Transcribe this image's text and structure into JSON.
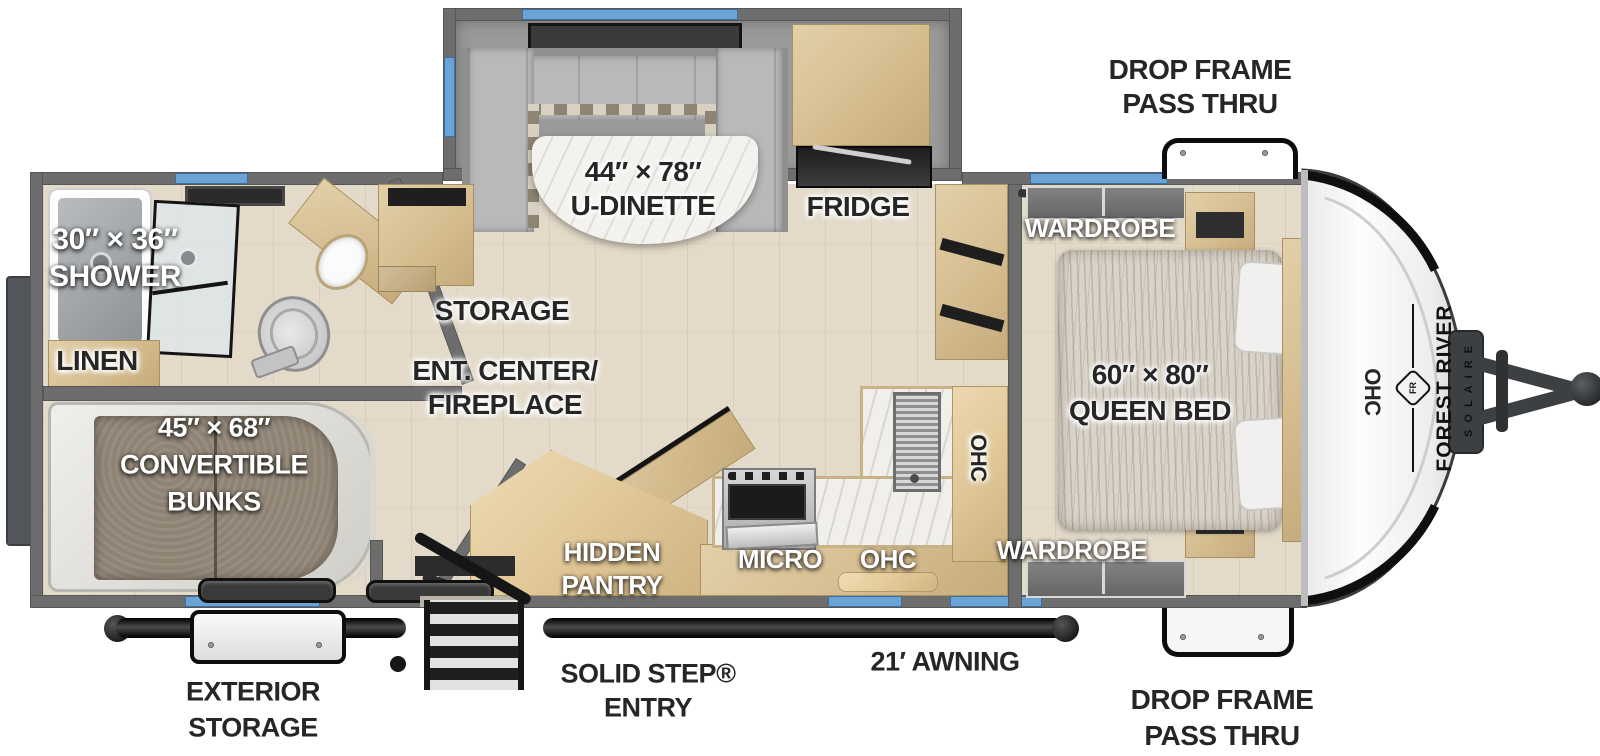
{
  "title": "Forest River Solaire travel trailer floor plan",
  "brand": {
    "name": "FOREST RIVER",
    "model": "SOLAIRE",
    "logo_monogram": "FR"
  },
  "labels": {
    "drop_frame_top_1": "DROP FRAME",
    "drop_frame_top_2": "PASS THRU",
    "dinette_size": "44″ × 78″",
    "dinette_name": "U-DINETTE",
    "fridge": "FRIDGE",
    "wardrobe_top": "WARDROBE",
    "wardrobe_bottom": "WARDROBE",
    "shower_size": "30″ × 36″",
    "shower_name": "SHOWER",
    "linen": "LINEN",
    "storage": "STORAGE",
    "ent_center_1": "ENT. CENTER/",
    "ent_center_2": "FIREPLACE",
    "bunks_size": "45″ × 68″",
    "bunks_name_1": "CONVERTIBLE",
    "bunks_name_2": "BUNKS",
    "hidden_pantry_1": "HIDDEN",
    "hidden_pantry_2": "PANTRY",
    "micro": "MICRO",
    "ohc_kitchen_lower": "OHC",
    "ohc_kitchen_upper": "OHC",
    "ohc_front": "OHC",
    "queen_size": "60″ × 80″",
    "queen_name": "QUEEN BED",
    "exterior_storage_1": "EXTERIOR",
    "exterior_storage_2": "STORAGE",
    "solid_step_1": "SOLID STEP®",
    "solid_step_2": "ENTRY",
    "awning": "21′ AWNING",
    "drop_frame_bottom_1": "DROP FRAME",
    "drop_frame_bottom_2": "PASS THRU"
  },
  "colors": {
    "window_blue": "#6aa3d6",
    "wall_gray": "#6d6d6d",
    "floor_wood": "#e3dac9",
    "cabinet_wood": "#d5bd90",
    "awning_black": "#141414",
    "cap_white": "#f7f7f7",
    "label_dark": "#262626",
    "label_light": "#ffffff"
  }
}
